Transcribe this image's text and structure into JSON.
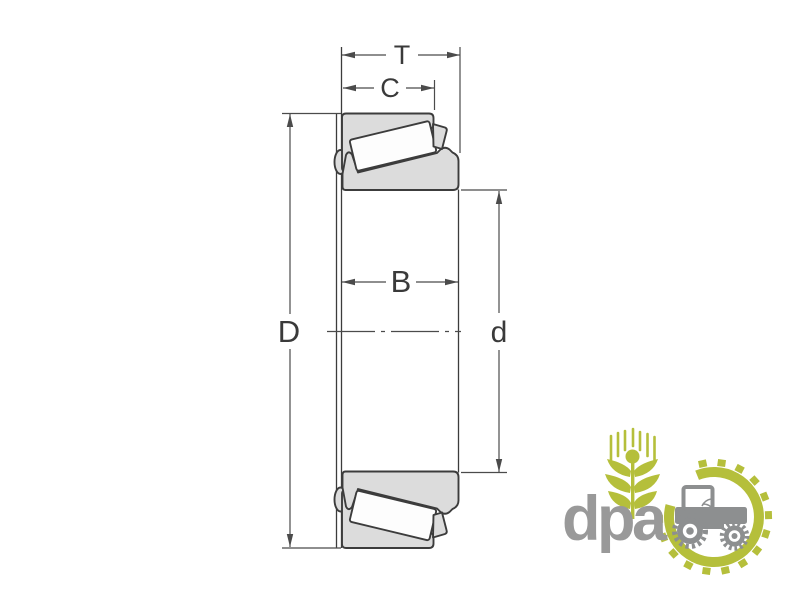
{
  "colors": {
    "background": "#ffffff",
    "bearing_fill": "#dcdcdc",
    "roller_fill": "#fdfdfd",
    "outline": "#3c3c3c",
    "dimension": "#4b4b4b",
    "label_text": "#3a3a3a",
    "logo_green": "#b5bf3b",
    "logo_gray": "#999999",
    "tractor_gray": "#8d8f90"
  },
  "diagram": {
    "type": "tapered-roller-bearing-cross-section",
    "dimension_labels": {
      "total_width": "T",
      "cup_width": "C",
      "cone_width": "B",
      "outer_diameter": "D",
      "bore_diameter": "d"
    }
  },
  "logo": {
    "wordmark": "dpa",
    "icons": [
      "wheat-icon",
      "tractor-icon",
      "gear-ring-icon"
    ]
  }
}
